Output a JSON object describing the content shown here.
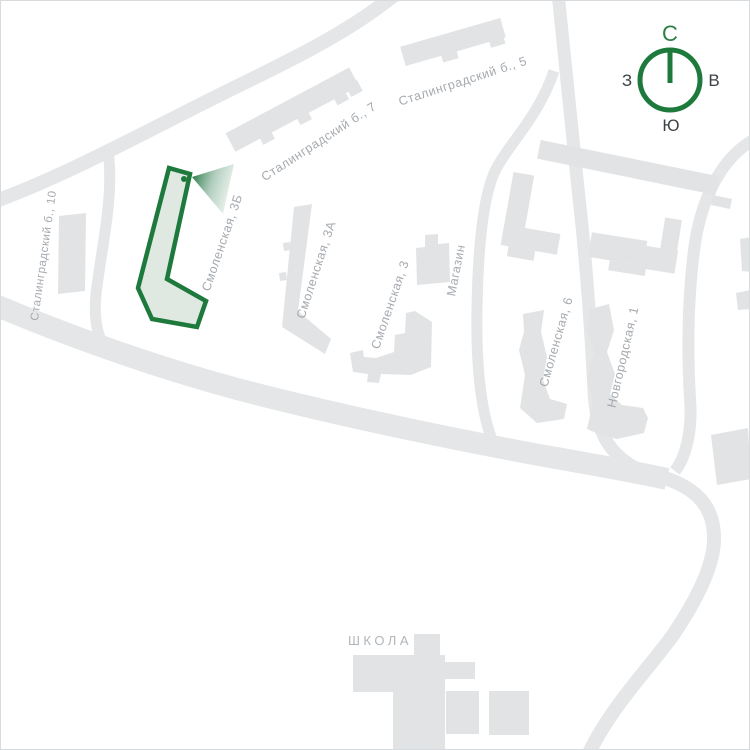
{
  "map": {
    "type": "residential-site-plan",
    "highlighted_building": "Смоленская, 3Б",
    "labels": {
      "stalingradsky_10": "Сталинградский б., 10",
      "stalingradsky_7": "Сталинградский б., 7",
      "stalingradsky_5": "Сталинградский б., 5",
      "smolenskaya_3b": "Смоленская, 3Б",
      "smolenskaya_3a": "Смоленская, 3А",
      "smolenskaya_3": "Смоленская, 3",
      "magazin": "Магазин",
      "smolenskaya_6": "Смоленская, 6",
      "novgorodskaya_1": "Новгородская, 1",
      "school": "ШКОЛА"
    },
    "compass": {
      "north": "С",
      "east": "В",
      "south": "Ю",
      "west": "З"
    },
    "colors": {
      "highlight_stroke": "#1e7a3c",
      "highlight_fill": "#dfe9e2",
      "building": "#e1e3e5",
      "road": "#e4e6e7",
      "label": "#a5aaaf",
      "compass_letter": "#3d4247",
      "background": "#ffffff"
    }
  }
}
